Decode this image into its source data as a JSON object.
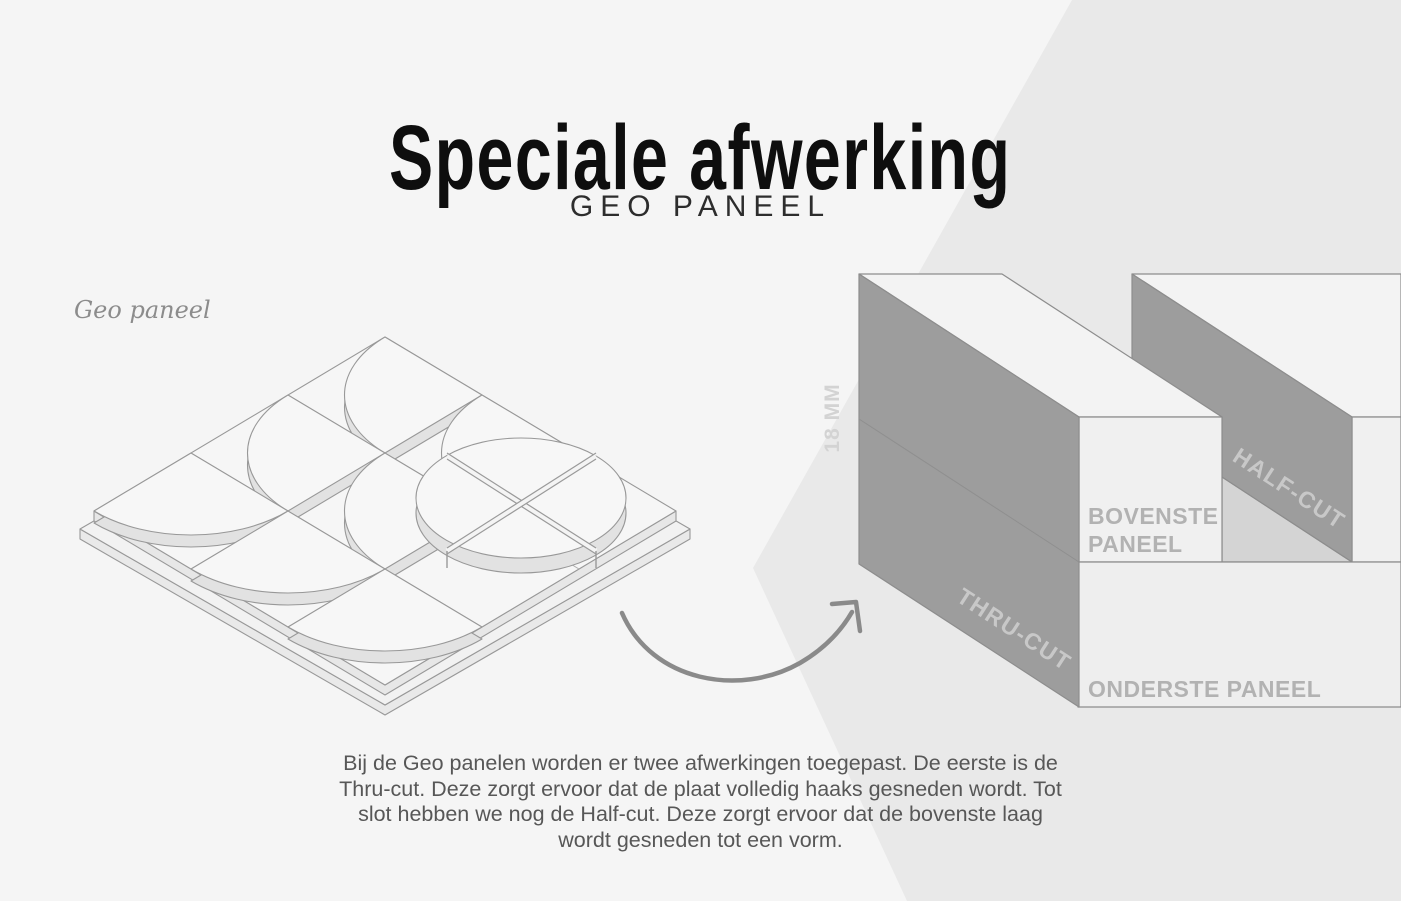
{
  "header": {
    "title": "Speciale afwerking",
    "subtitle": "GEO PANEEL"
  },
  "left_illustration": {
    "caption": "Geo paneel"
  },
  "right_illustration": {
    "thickness_label": "18 MM",
    "thru_cut_label": "THRU-CUT",
    "half_cut_label": "HALF-CUT",
    "top_panel_label_line1": "BOVENSTE",
    "top_panel_label_line2": "PANEEL",
    "bottom_panel_label": "ONDERSTE PANEEL"
  },
  "description": {
    "line1": "Bij de Geo panelen worden er twee afwerkingen toegepast. De eerste is de",
    "line2": "Thru-cut. Deze zorgt ervoor dat de plaat volledig haaks gesneden wordt. Tot",
    "line3": "slot hebben we nog de Half-cut. Deze zorgt ervoor dat de bovenste laag",
    "line4": "wordt gesneden tot een vorm."
  },
  "colors": {
    "page_background": "#f5f5f5",
    "background_wedge": "#e9e9e9",
    "cut_face": "#9d9d9d",
    "panel_face": "#f0f0f0",
    "panel_top_face": "#f3f3f3",
    "exposed_bottom_panel": "#d4d4d4",
    "outline": "#8d8d8d",
    "title_text": "#0e0e0e",
    "body_text": "#575757",
    "panel_label_text": "#b2b2b2",
    "cut_label_text": "#c8c8c8",
    "arrow": "#8a8a8a"
  }
}
